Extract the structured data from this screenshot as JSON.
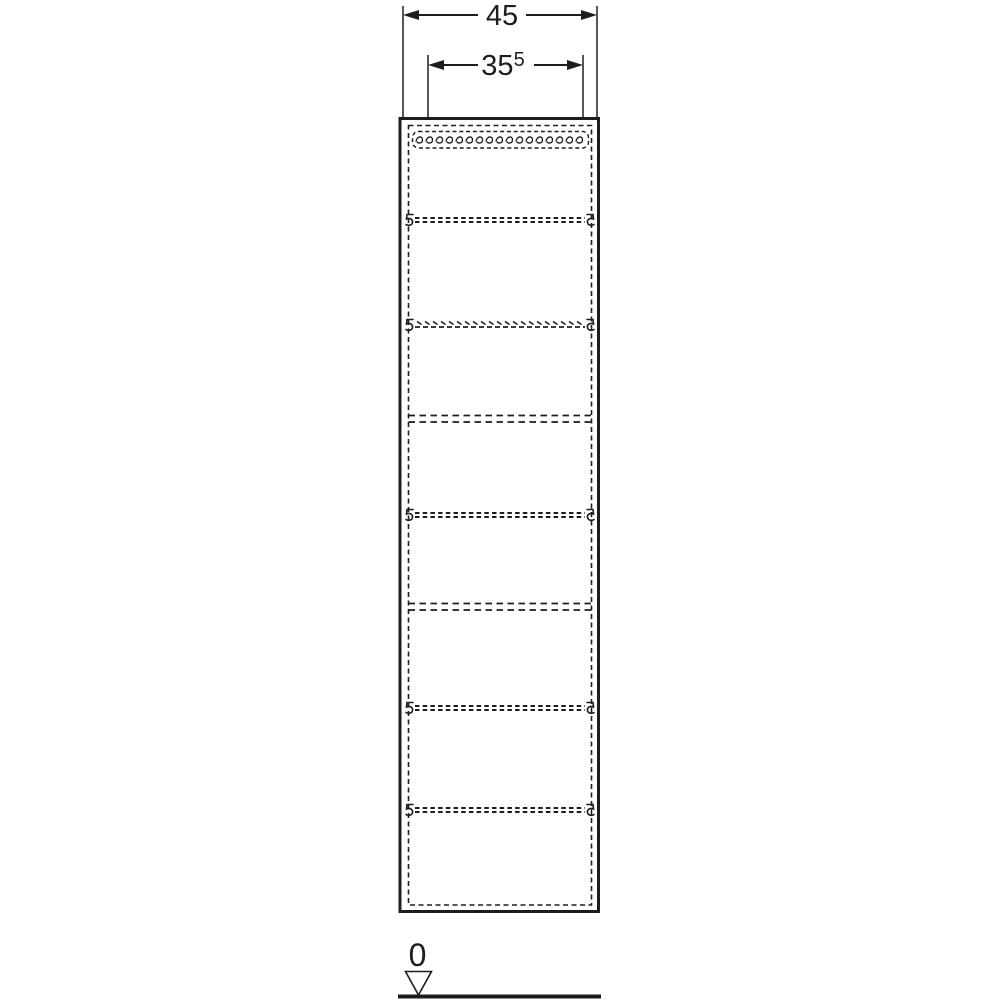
{
  "page": {
    "background": "#ffffff",
    "ink_color": "#1d1d1b"
  },
  "dimension_labels": {
    "outer_width": "45",
    "inner_width": "35",
    "inner_width_superscript": "5",
    "floor_level": "0"
  },
  "icons": {
    "level_marker": "triangle-down-icon",
    "shelf_support": "shelf-pin-hook-icon",
    "dimension_arrows": "filled-arrowhead-icon"
  },
  "drawing": {
    "view": "tall-cabinet-front-elevation",
    "adjustable_shelf_lines": 5,
    "fixed_divider_lines": 2,
    "handle_recess_shown_hidden": true
  }
}
